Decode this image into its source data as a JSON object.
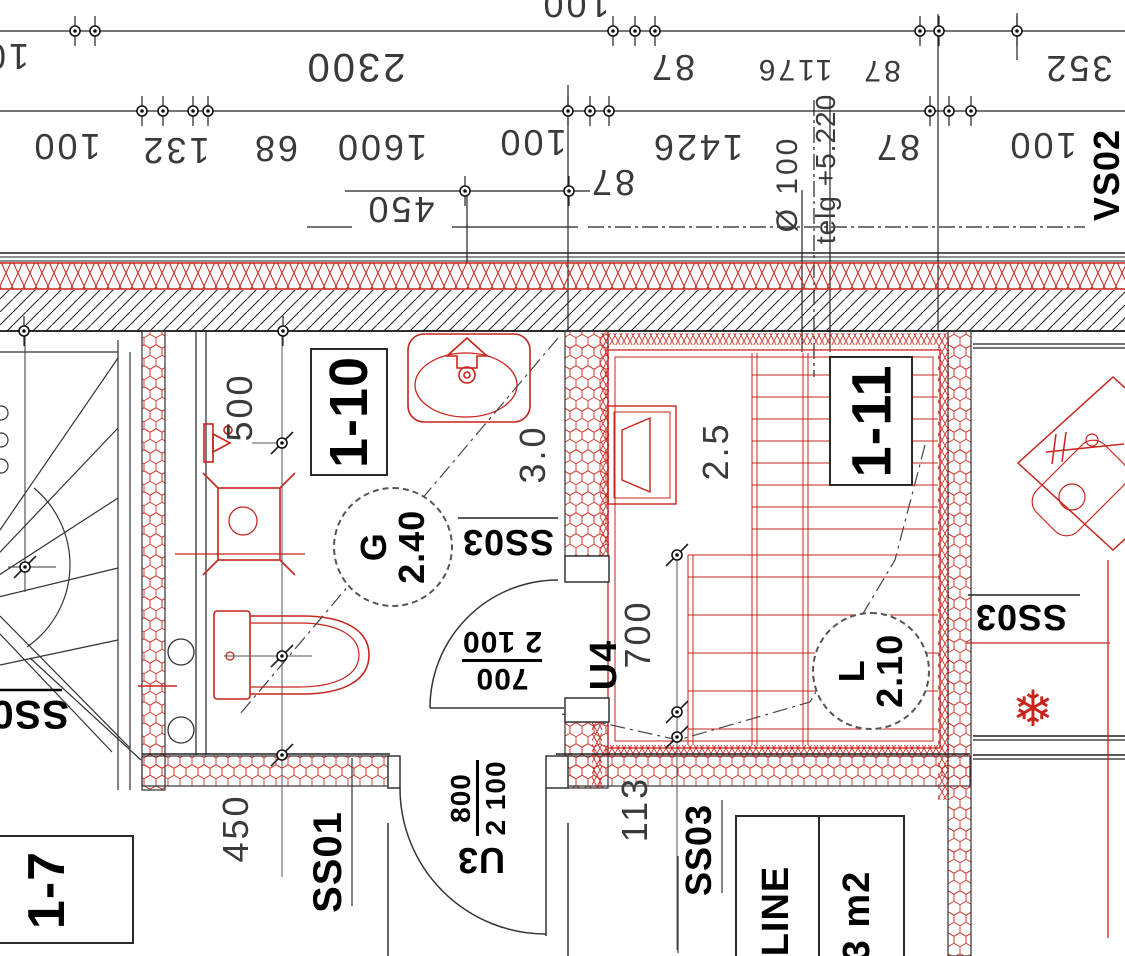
{
  "colors": {
    "red": "#c8241c",
    "line": "#222222",
    "dim_text": "#3a3a3a"
  },
  "dims": {
    "a100": "100",
    "a10": "10",
    "a2300": "2300",
    "a87": "87",
    "a1176": "1176",
    "b87": "87",
    "a352": "352",
    "b100": "100",
    "a132": "132",
    "a68": "68",
    "a1600": "1600",
    "c100": "100",
    "a1426": "1426",
    "c87": "87",
    "d100": "100",
    "d87": "87",
    "a450": "450",
    "dia100": "Ø 100",
    "telg": "telg +5.220",
    "a500": "500",
    "a30": "3.0",
    "a25": "2.5",
    "a700": "700",
    "b450": "450",
    "a113": "113"
  },
  "labels": {
    "vs02": "VS02",
    "room_110": "1-10",
    "room_111": "1-11",
    "room_17": "1-7",
    "g_tag": "G",
    "g_height": "2.40",
    "l_tag": "L",
    "l_height": "2.10",
    "ss03": "SS03",
    "ss01": "SS01",
    "u4": "U4",
    "u3": "U3",
    "u4_w": "700",
    "u4_h": "2 100",
    "u3_w": "800",
    "u3_h": "2 100",
    "table_material": "LINE",
    "table_area": "3 m2"
  },
  "icons": {
    "snowflake": "❄"
  }
}
